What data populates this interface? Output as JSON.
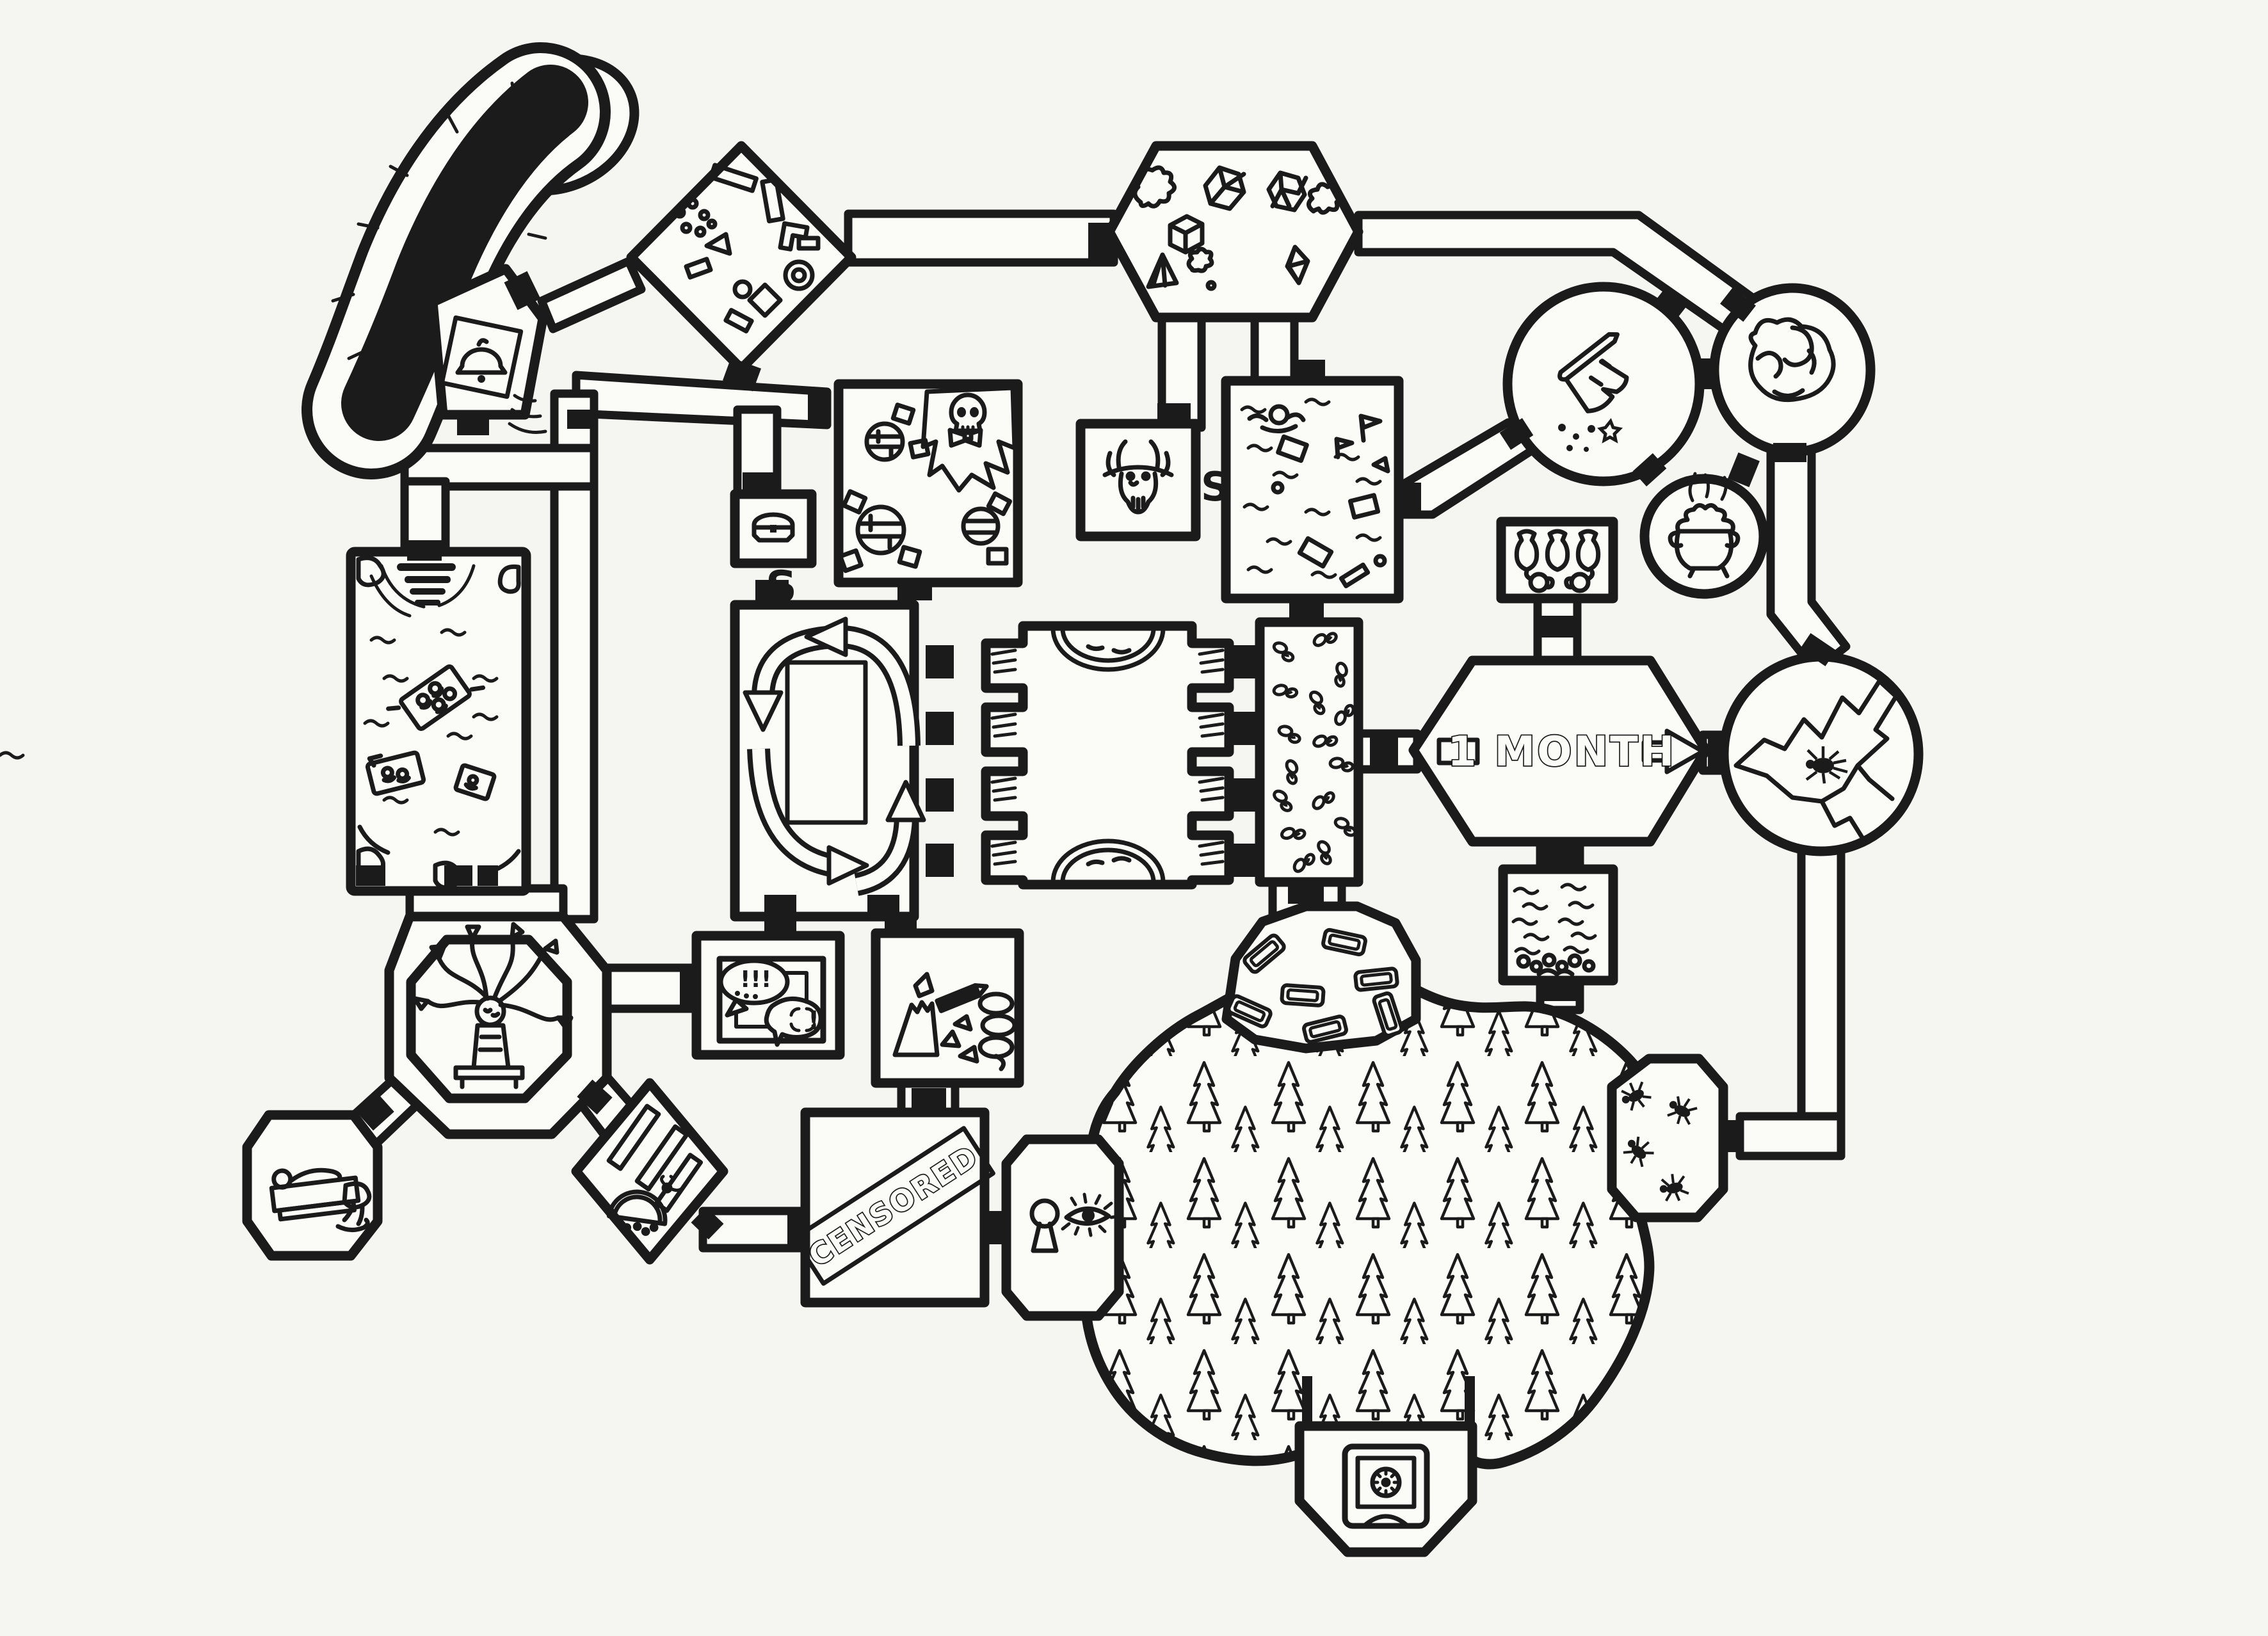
{
  "colors": {
    "ink": "#1b1b1b",
    "paper": "#f5f5f2",
    "floor": "#fbfbf8"
  },
  "labels": {
    "month": "1 MONTH",
    "censored": "CENSORED",
    "secret_chest": "S",
    "secret_demon": "S",
    "exclaim": "!!!",
    "anger": "!"
  },
  "features": [
    {
      "id": "dark-slide",
      "icon": "black-chute-icon",
      "desc": "curved black slide/chasm entrance, top-left"
    },
    {
      "id": "alarm-room",
      "icon": "ringing-bell-icon",
      "desc": "pentagon room with ringing bell on tilted plinth"
    },
    {
      "id": "junk-room",
      "icon": "scattered-junk-icon",
      "desc": "diamond room full of scattered blocks and pieces"
    },
    {
      "id": "gem-hall",
      "icon": "gems-icon",
      "desc": "long hexagonal hall with gems, dice shapes and blobs"
    },
    {
      "id": "crumb-circle",
      "icon": "crumbling-log-icon",
      "desc": "big circle with crumbling log dropping crumbs"
    },
    {
      "id": "brain-circle",
      "icon": "brain-boulder-icon",
      "desc": "circle containing wrinkled brain-like boulder"
    },
    {
      "id": "cauldron-circle",
      "icon": "bubbling-cauldron-icon",
      "desc": "small circle with steaming cauldron"
    },
    {
      "id": "urn-room",
      "icon": "urns-and-jugs-icon",
      "desc": "room with three urns and two jugs"
    },
    {
      "id": "skull-tavern",
      "icon": "skull-bowtie-icon",
      "desc": "tavern with round tables, stools, skull with bowtie in torn hole"
    },
    {
      "id": "chest-room",
      "icon": "treasure-chest-icon",
      "desc": "small room with treasure chest, secret door S"
    },
    {
      "id": "demon-room",
      "icon": "horned-skull-icon",
      "desc": "small room with horned demon skull, secret door S"
    },
    {
      "id": "flood-room",
      "icon": "swimmer-icon",
      "desc": "flooded room with swimmer and floating debris"
    },
    {
      "id": "river-room",
      "icon": "raft-icon",
      "desc": "river room with waterfall, rafts with riders, rocks"
    },
    {
      "id": "loop-room",
      "icon": "circulating-arrows-icon",
      "desc": "room with four arrows looping around central block"
    },
    {
      "id": "cell-room",
      "icon": "vented-alcoves-icon",
      "desc": "hall with vented alcoves on both sides and domed rugs"
    },
    {
      "id": "bone-room",
      "icon": "scattered-bones-icon",
      "desc": "narrow room littered with small bone clusters"
    },
    {
      "id": "month-sign",
      "icon": "one-month-arrow-icon",
      "desc": "hexagonal room with 1 MONTH arrow sign"
    },
    {
      "id": "crevasse-circle",
      "icon": "crack-spider-icon",
      "desc": "circle with jagged crevasse and spider"
    },
    {
      "id": "medusa-room",
      "icon": "medusa-icon",
      "desc": "octagon ring room with seated medusa creature"
    },
    {
      "id": "frame-room",
      "icon": "argument-bubbles-icon",
      "desc": "room with picture frame and arguing speech bubbles"
    },
    {
      "id": "broken-room",
      "icon": "broken-items-icon",
      "desc": "room with cracked cone, shards, pencil and spring"
    },
    {
      "id": "pond-room",
      "icon": "pond-pebbles-icon",
      "desc": "room of water lines with pebbles at bottom"
    },
    {
      "id": "sleeper-room",
      "icon": "sleeping-figure-icon",
      "desc": "octagon with figure lying on slab and spilled puddle"
    },
    {
      "id": "plank-room",
      "icon": "planks-melon-icon",
      "desc": "diamond room with slanted planks, melon slice and fly"
    },
    {
      "id": "censored-room",
      "icon": "censored-banner-icon",
      "desc": "large room with diagonal CENSORED banner"
    },
    {
      "id": "keyhole-room",
      "icon": "keyhole-eye-icon",
      "desc": "octagon with keyhole and peeking eye"
    },
    {
      "id": "pine-forest",
      "icon": "pine-trees-icon",
      "desc": "huge blob of dense pine forest"
    },
    {
      "id": "crate-clearing",
      "icon": "crates-icon",
      "desc": "forest entrance clearing with scattered crates/coffins"
    },
    {
      "id": "safe-room",
      "icon": "safe-vault-icon",
      "desc": "room below forest holding a dial safe"
    },
    {
      "id": "ant-room",
      "icon": "ants-icon",
      "desc": "octagon at forest edge with crawling ants"
    }
  ]
}
